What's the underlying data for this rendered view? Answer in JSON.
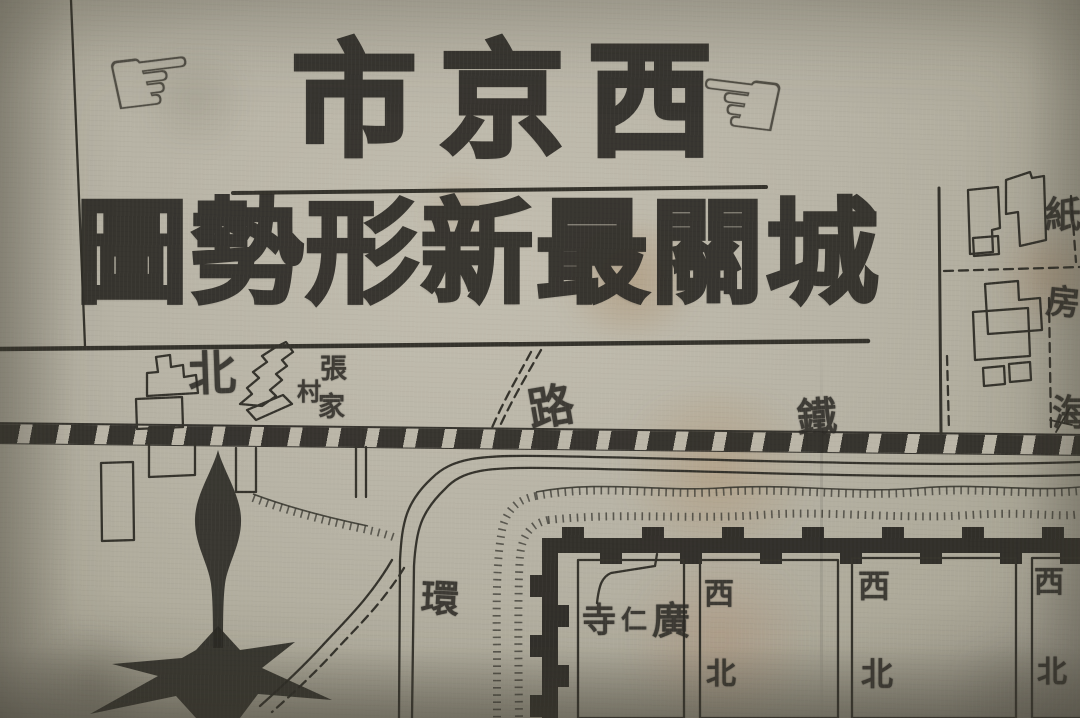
{
  "title": {
    "line1": "市京西",
    "line2": "圖勢形新最關城"
  },
  "hands": {
    "right_pointing": "☞",
    "left_pointing": "☜"
  },
  "labels": {
    "north": "北",
    "village_zhang": "張",
    "village_cun": "村",
    "village_jia": "家",
    "road": "路",
    "iron": "鐵",
    "ring": "環",
    "zhi": "紙",
    "fang": "房",
    "hai": "海",
    "temple_si": "寺",
    "temple_ren": "仁",
    "temple_guang": "廣"
  },
  "city_blocks": [
    {
      "top": "西",
      "bottom": "北"
    },
    {
      "top": "西",
      "bottom": "北"
    },
    {
      "top": "西",
      "bottom": "北"
    }
  ],
  "colors": {
    "paper": "#b7b3a5",
    "ink": "#2e2c27",
    "stain_brown": "#9a7450"
  }
}
